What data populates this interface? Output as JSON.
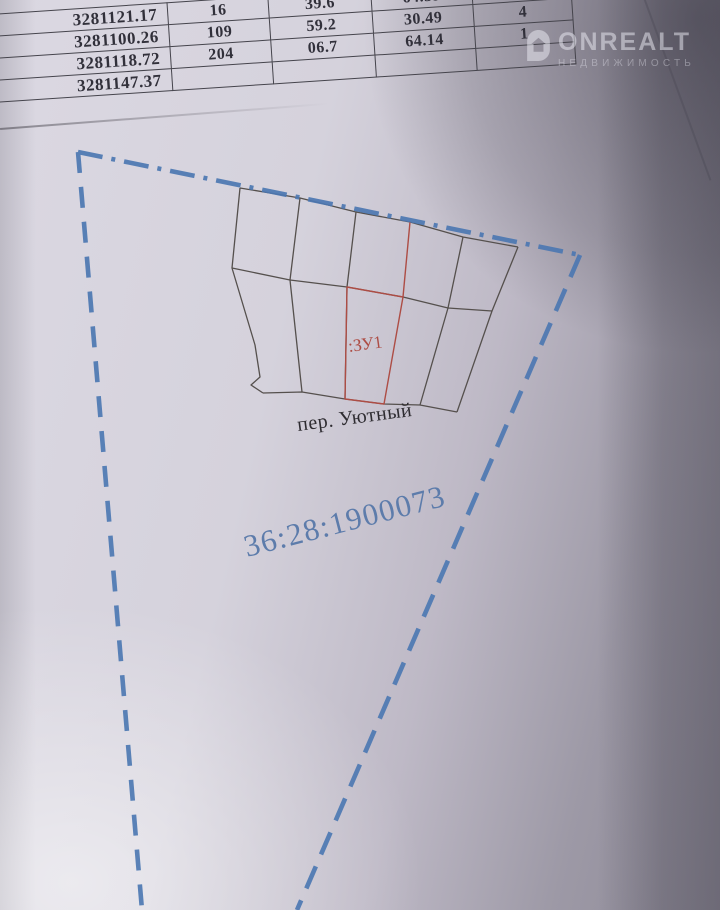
{
  "coordinate_table": {
    "rows": [
      [
        "3281121.17",
        "16",
        "39.6",
        "64.39",
        ""
      ],
      [
        "3281100.26",
        "109",
        "59.2",
        "30.49",
        "4"
      ],
      [
        "3281118.72",
        "204",
        "06.7",
        "64.14",
        "1"
      ],
      [
        "3281147.37",
        "",
        "",
        "",
        ""
      ]
    ]
  },
  "plan": {
    "parcel_label": ":ЗУ1",
    "street_label": "пер. Уютный",
    "cadastral_number": "36:28:1900073"
  },
  "watermark": {
    "brand": "ONREALT",
    "subtitle": "НЕДВИЖИМОСТЬ"
  },
  "colors": {
    "boundary_blue": "#4d78b2",
    "parcel_red": "#ad4d45",
    "cadastral_blue": "#5d7cab",
    "drawing_line": "#55504d",
    "street_text": "#2e2c31"
  }
}
